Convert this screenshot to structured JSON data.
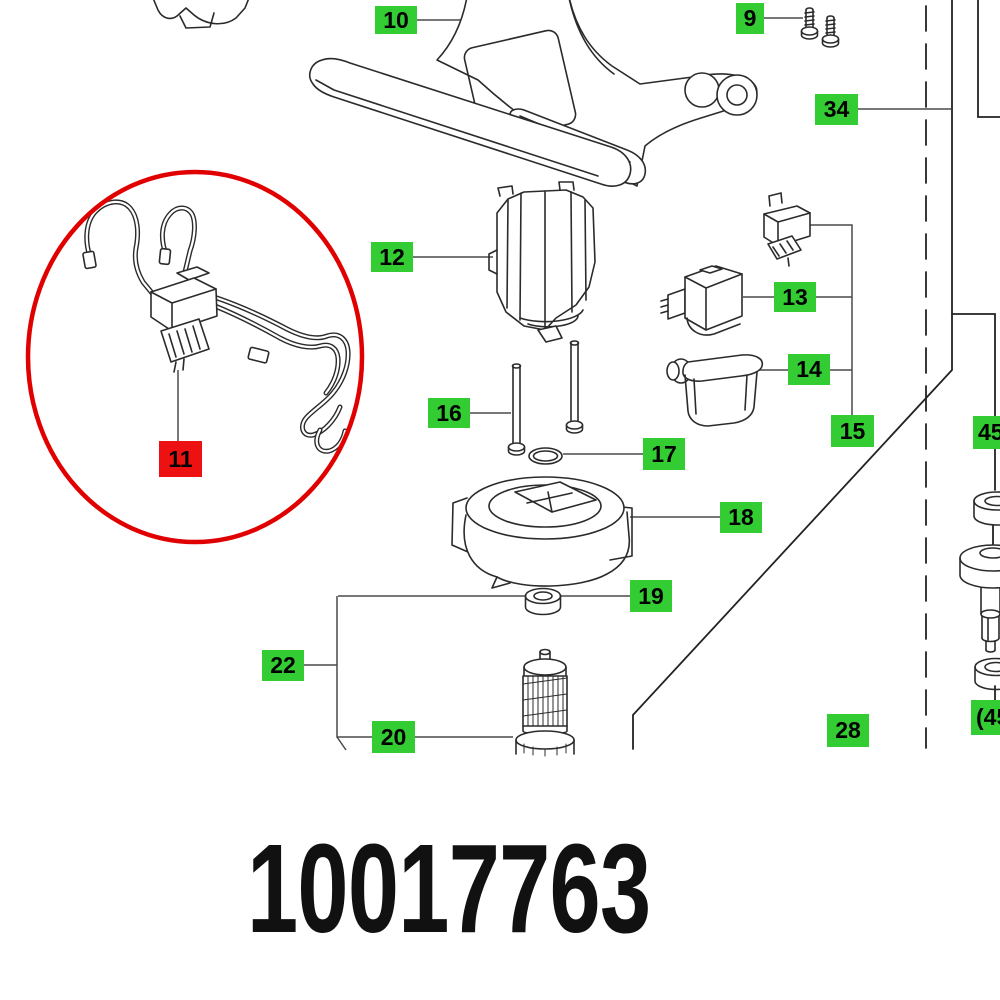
{
  "diagram": {
    "title_part_number": "10017763",
    "part_number": "10017763",
    "selected_part_id": "11",
    "colors": {
      "label_green": "#33cc33",
      "label_red": "#ee1111",
      "highlight_circle_red": "#e10000",
      "line_dark": "#2b2b2b",
      "leader_gray": "#4a4a4a"
    },
    "labels": [
      {
        "id": "10",
        "text": "10",
        "x": 375,
        "y": 6,
        "w": 42,
        "h": 28,
        "variant": "green"
      },
      {
        "id": "9",
        "text": "9",
        "x": 736,
        "y": 3,
        "w": 28,
        "h": 31,
        "variant": "green"
      },
      {
        "id": "34",
        "text": "34",
        "x": 815,
        "y": 94,
        "w": 43,
        "h": 31,
        "variant": "green"
      },
      {
        "id": "12",
        "text": "12",
        "x": 371,
        "y": 242,
        "w": 42,
        "h": 30,
        "variant": "green"
      },
      {
        "id": "13",
        "text": "13",
        "x": 774,
        "y": 282,
        "w": 42,
        "h": 30,
        "variant": "green"
      },
      {
        "id": "14",
        "text": "14",
        "x": 788,
        "y": 354,
        "w": 42,
        "h": 31,
        "variant": "green"
      },
      {
        "id": "15",
        "text": "15",
        "x": 831,
        "y": 415,
        "w": 43,
        "h": 32,
        "variant": "green"
      },
      {
        "id": "16",
        "text": "16",
        "x": 428,
        "y": 398,
        "w": 42,
        "h": 30,
        "variant": "green"
      },
      {
        "id": "17",
        "text": "17",
        "x": 643,
        "y": 438,
        "w": 42,
        "h": 32,
        "variant": "green"
      },
      {
        "id": "18",
        "text": "18",
        "x": 720,
        "y": 502,
        "w": 42,
        "h": 31,
        "variant": "green"
      },
      {
        "id": "19",
        "text": "19",
        "x": 630,
        "y": 580,
        "w": 42,
        "h": 32,
        "variant": "green"
      },
      {
        "id": "22",
        "text": "22",
        "x": 262,
        "y": 650,
        "w": 42,
        "h": 31,
        "variant": "green"
      },
      {
        "id": "20",
        "text": "20",
        "x": 372,
        "y": 721,
        "w": 43,
        "h": 32,
        "variant": "green"
      },
      {
        "id": "28",
        "text": "28",
        "x": 827,
        "y": 714,
        "w": 42,
        "h": 33,
        "variant": "green"
      },
      {
        "id": "45",
        "text": "45",
        "x": 973,
        "y": 416,
        "w": 50,
        "h": 33,
        "variant": "green",
        "align": "left"
      },
      {
        "id": "45b",
        "text": "(45)",
        "x": 971,
        "y": 700,
        "w": 58,
        "h": 35,
        "variant": "green",
        "align": "left"
      },
      {
        "id": "11",
        "text": "11",
        "x": 159,
        "y": 441,
        "w": 43,
        "h": 36,
        "variant": "red"
      }
    ]
  }
}
